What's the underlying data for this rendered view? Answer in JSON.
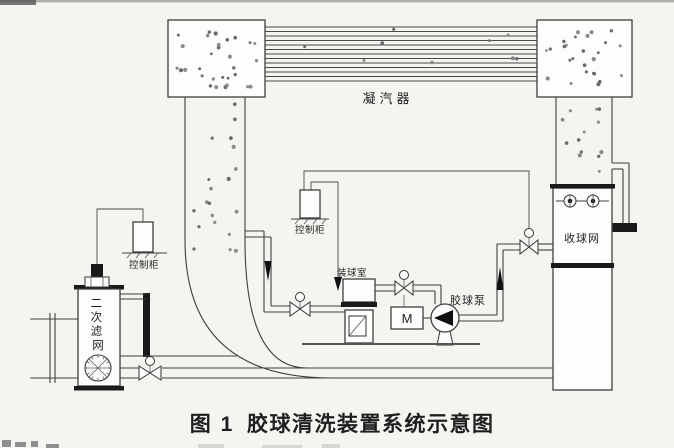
{
  "caption": {
    "figure_no": "图 1",
    "title": "胶球清洗装置系统示意图"
  },
  "labels": {
    "condenser": "凝汽器",
    "control_cabinet_left": "控制柜",
    "control_cabinet_middle": "控制柜",
    "secondary_filter": "二次滤网",
    "secondary_filter_chars": [
      "二",
      "次",
      "滤",
      "网"
    ],
    "ball_chamber": "装球室",
    "ball_pump": "胶球泵",
    "motor": "M",
    "ball_collector": "收球网"
  },
  "icons": {
    "balls": "rubber-ball-dots",
    "valves": "bowtie-valve-with-actuator",
    "pump": "centrifugal-pump",
    "screen": "circular-strainer-screen",
    "handwheels": "isolation-handwheel-pair"
  },
  "colors": {
    "line": "#3f3f3f",
    "ink": "#1a1a1a",
    "paper": "#f5f4f1"
  }
}
